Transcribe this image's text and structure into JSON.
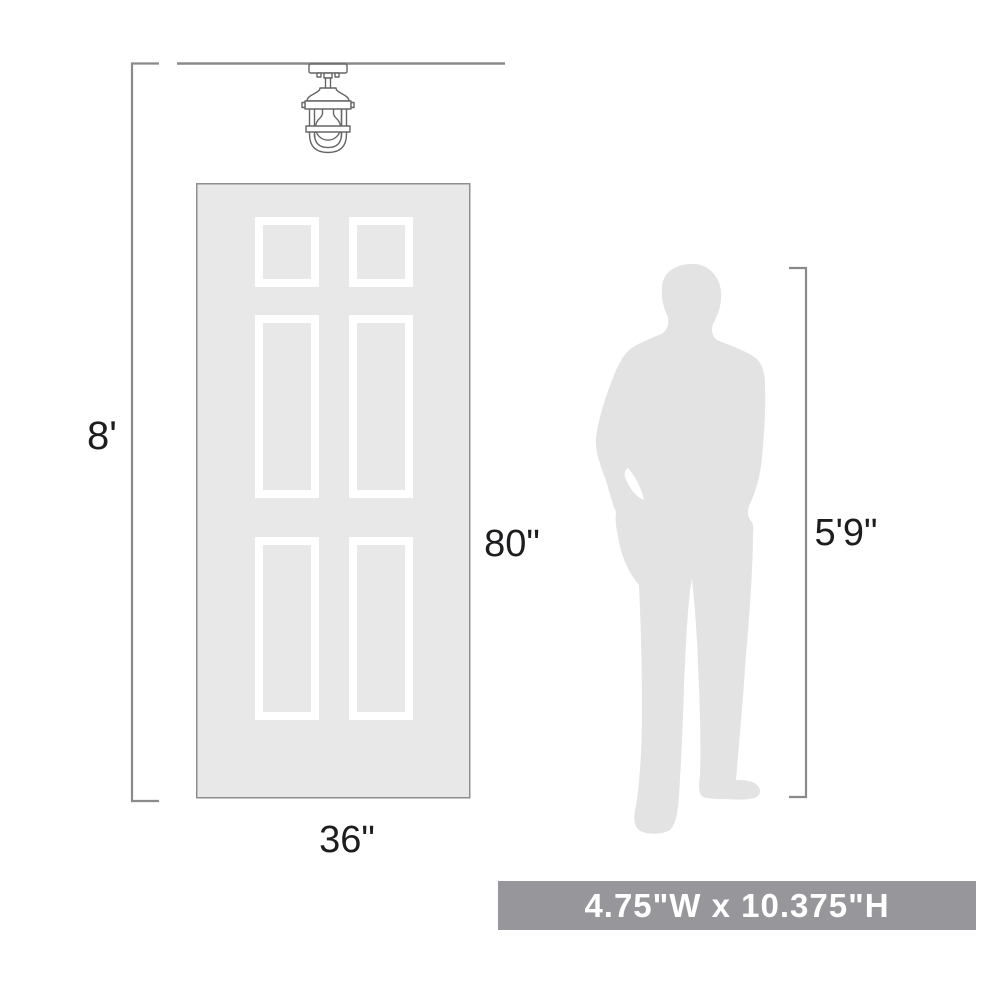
{
  "diagram": {
    "type": "product-scale-diagram",
    "labels": {
      "ceiling_height": "8'",
      "door_height": "80\"",
      "door_width": "36\"",
      "person_height": "5'9\""
    },
    "banner": {
      "text": "4.75\"W x 10.375\"H"
    },
    "icons": [
      "ceiling-light-fixture-icon",
      "six-panel-door",
      "person-silhouette"
    ],
    "colors": {
      "door_fill": "#e8e8e8",
      "door_border": "#8f8f8f",
      "panel_frame": "#ffffff",
      "silhouette_fill": "#e3e3e3",
      "dimension_line": "#8a8a8a",
      "label_text": "#1d1d1f",
      "fixture_stroke": "#666666",
      "banner_bg": "#97979b",
      "banner_text": "#ffffff"
    }
  }
}
